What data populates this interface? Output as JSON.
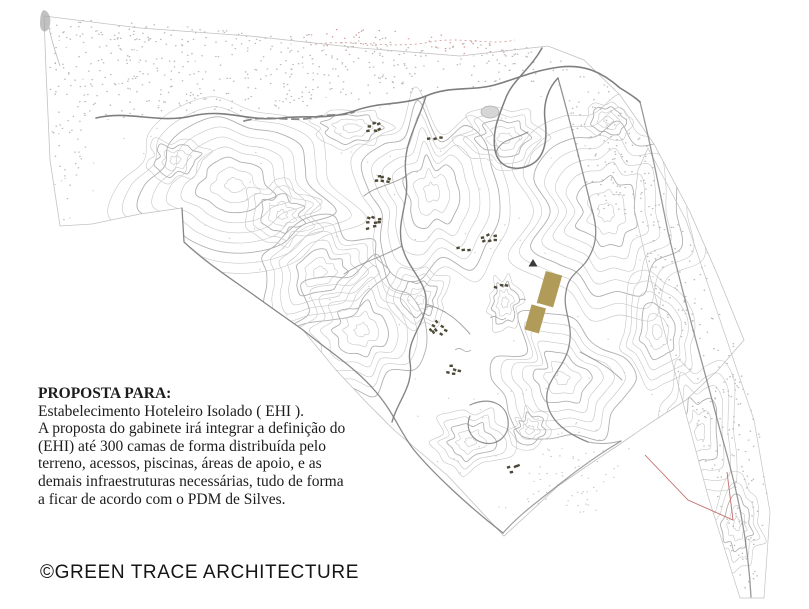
{
  "proposal": {
    "heading": "PROPOSTA PARA:",
    "lines": [
      "Estabelecimento Hoteleiro Isolado ( EHI ).",
      "A proposta do gabinete irá integrar a definição do",
      "(EHI) até 300 camas de forma distribuída pelo",
      "terreno, acessos, piscinas, áreas de apoio, e as",
      "demais infraestruturas necessárias, tudo de forma",
      "a ficar de acordo com o PDM de Silves."
    ]
  },
  "footer": {
    "copyright": "©GREEN TRACE ARCHITECTURE"
  },
  "colors": {
    "background": "#ffffff",
    "contour_line": "#c9c9c9",
    "contour_index": "#b0b0b0",
    "boundary": "#c2c2c2",
    "road": "#7e7e7e",
    "stipple": "#bababa",
    "stipple_sparse": "#c8c8c8",
    "stipple_red": "#cf9292",
    "building_cluster": "#4e4a36",
    "proposed_building": "#b09b58",
    "red_boundary": "#c46a6a",
    "marker": "#3a3a3a",
    "text": "#1c1c1c"
  }
}
